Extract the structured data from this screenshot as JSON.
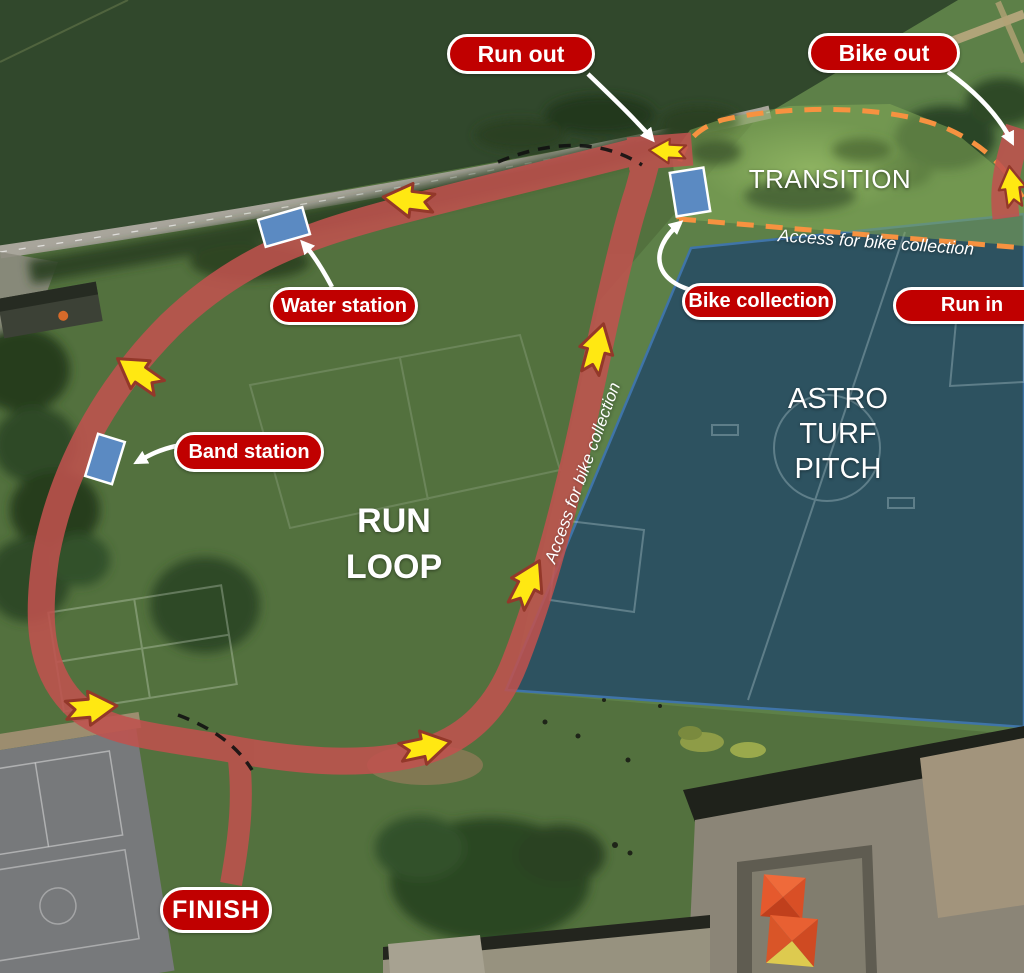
{
  "pills": {
    "run_out": "Run out",
    "bike_out": "Bike out",
    "water_station": "Water station",
    "band_station": "Band station",
    "bike_collection": "Bike collection",
    "run_in": "Run in",
    "finish": "FINISH"
  },
  "areas": {
    "transition": "TRANSITION",
    "run_loop": [
      "RUN",
      "LOOP"
    ],
    "astro_turf_pitch": [
      "ASTRO",
      "TURF",
      "PITCH"
    ],
    "access_for_bike_collection_path": "Access for bike collection",
    "access_for_bike_collection_transition": "Access for bike collection"
  },
  "markers": {
    "water_station": "blue-rectangle",
    "band_station": "blue-rectangle",
    "bike_collection": "blue-rectangle"
  },
  "colors": {
    "label_background": "#c00000",
    "label_text": "#ffffff",
    "route": "#c0524e",
    "direction_arrow": "#ffe812",
    "direction_arrow_outline": "#93382a",
    "transition_boundary": "#f79240",
    "station_marker": "#5b8ac2",
    "astro_pitch": "#2d5260",
    "crop_field": "#31482c"
  }
}
